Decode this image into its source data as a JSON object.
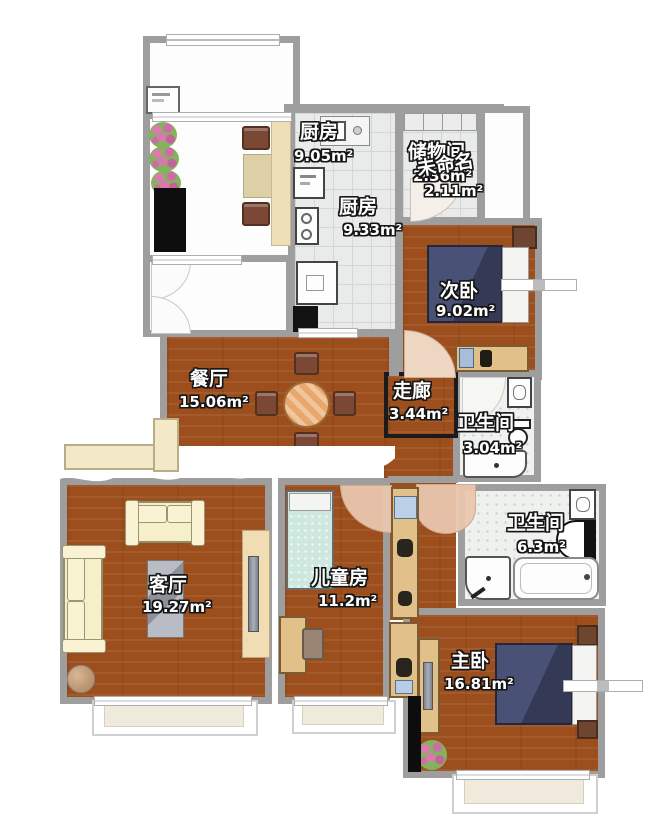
{
  "meta": {
    "title": "三室两厅户型图",
    "unit": "m²"
  },
  "rooms": {
    "kitchen_upper": {
      "name": "厨房",
      "area": "9.05m²"
    },
    "kitchen_lower": {
      "name": "厨房",
      "area": "9.33m²"
    },
    "storage": {
      "name": "储物间",
      "area": "2.36m²"
    },
    "unnamed": {
      "name": "未命名",
      "area": "2.11m²"
    },
    "second_bedroom": {
      "name": "次卧",
      "area": "9.02m²"
    },
    "dining": {
      "name": "餐厅",
      "area": "15.06m²"
    },
    "corridor": {
      "name": "走廊",
      "area": "3.44m²"
    },
    "bath_small": {
      "name": "卫生间",
      "area": "3.04m²"
    },
    "bath_large": {
      "name": "卫生间",
      "area": "6.3m²"
    },
    "living": {
      "name": "客厅",
      "area": "19.27m²"
    },
    "kids": {
      "name": "儿童房",
      "area": "11.2m²"
    },
    "master": {
      "name": "主卧",
      "area": "16.81m²"
    }
  },
  "colors": {
    "wall": "#9e9e9e",
    "wood_floor": "#9c4e1d",
    "kitchen_tile": "#e9ebea",
    "bath_tile": "#eef1ee",
    "navy_bed": "#3f4566",
    "mint_bed": "#cfe8df",
    "cream_sofa": "#f5efca",
    "tan_cabinet": "#e2c089",
    "door_swing": "#e9c9b2"
  },
  "furniture_legend": [
    "washing-machine",
    "flower-pot",
    "floor-mat",
    "balcony-chair",
    "balcony-table",
    "kitchen-sink",
    "refrigerator",
    "stove",
    "oven-cabinet",
    "storage-shelf",
    "double-bed",
    "pillow",
    "nightstand",
    "desk",
    "desk-chair",
    "dining-table",
    "dining-chair",
    "sofa",
    "coffee-table-rug",
    "tv-cabinet",
    "tv",
    "round-stool",
    "kids-bed",
    "hall-cabinet",
    "washbasin",
    "toilet",
    "shower",
    "bathtub",
    "bay-window",
    "door-swing-arc",
    "wardrobe"
  ]
}
